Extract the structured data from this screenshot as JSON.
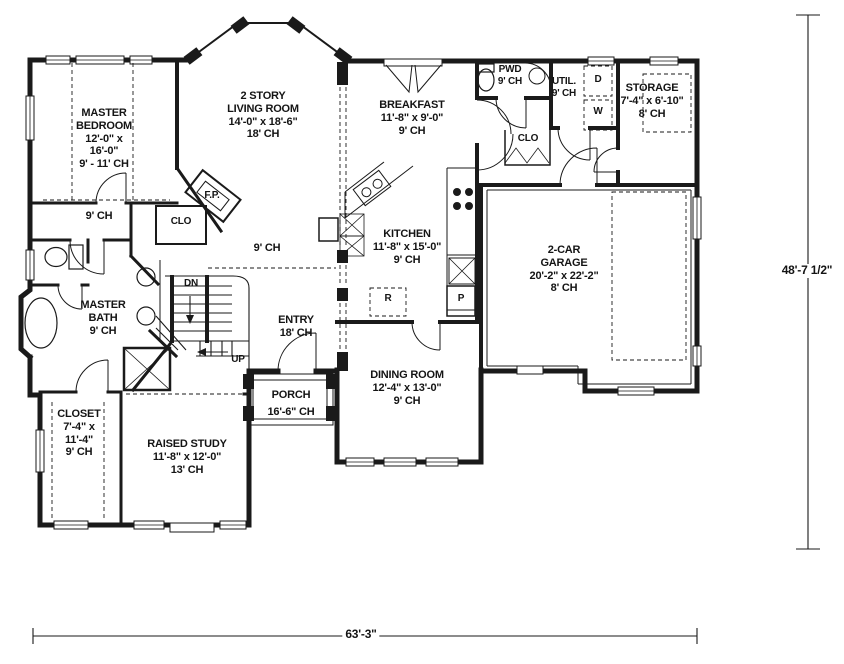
{
  "drawing": {
    "paper_color": "#ffffff",
    "ink_color": "#1a1a1a"
  },
  "rooms": {
    "master_bedroom": {
      "lines": [
        "MASTER",
        "BEDROOM",
        "12'-0\" x",
        "16'-0\"",
        "9' - 11' CH"
      ]
    },
    "living_room": {
      "lines": [
        "2 STORY",
        "LIVING ROOM",
        "14'-0\" x 18'-6\"",
        "18' CH"
      ]
    },
    "breakfast": {
      "lines": [
        "BREAKFAST",
        "11'-8\" x 9'-0\"",
        "9' CH"
      ]
    },
    "powder": {
      "lines": [
        "PWD",
        "9' CH"
      ]
    },
    "utility": {
      "lines": [
        "UTIL.",
        "9' CH"
      ]
    },
    "storage": {
      "lines": [
        "STORAGE",
        "7'-4\" x 6'-10\"",
        "8' CH"
      ]
    },
    "kitchen": {
      "lines": [
        "KITCHEN",
        "11'-8\" x 15'-0\"",
        "9' CH"
      ]
    },
    "garage": {
      "lines": [
        "2-CAR",
        "GARAGE",
        "20'-2\" x 22'-2\"",
        "8' CH"
      ]
    },
    "master_bath": {
      "lines": [
        "MASTER",
        "BATH",
        "9' CH"
      ]
    },
    "entry": {
      "lines": [
        "ENTRY",
        "18' CH"
      ]
    },
    "porch": {
      "lines": [
        "PORCH",
        "16'-6\" CH"
      ]
    },
    "dining_room": {
      "lines": [
        "DINING ROOM",
        "12'-4\" x 13'-0\"",
        "9' CH"
      ]
    },
    "closet": {
      "lines": [
        "CLOSET",
        "7'-4\" x",
        "11'-4\"",
        "9' CH"
      ]
    },
    "raised_study": {
      "lines": [
        "RAISED STUDY",
        "11'-8\" x 12'-0\"",
        "13' CH"
      ]
    }
  },
  "annotations": {
    "hall_ceiling_left": "9' CH",
    "hall_ceiling_center": "9' CH",
    "stairs_down": "DN",
    "stairs_up": "UP",
    "closet_fireplace": "CLO",
    "closet_hall": "CLO",
    "fireplace": "F.P.",
    "refrigerator": "R",
    "pantry": "P",
    "dryer": "D",
    "washer": "W"
  },
  "dimensions": {
    "overall_width": "63'-3\"",
    "overall_depth": "48'-7 1/2\""
  }
}
